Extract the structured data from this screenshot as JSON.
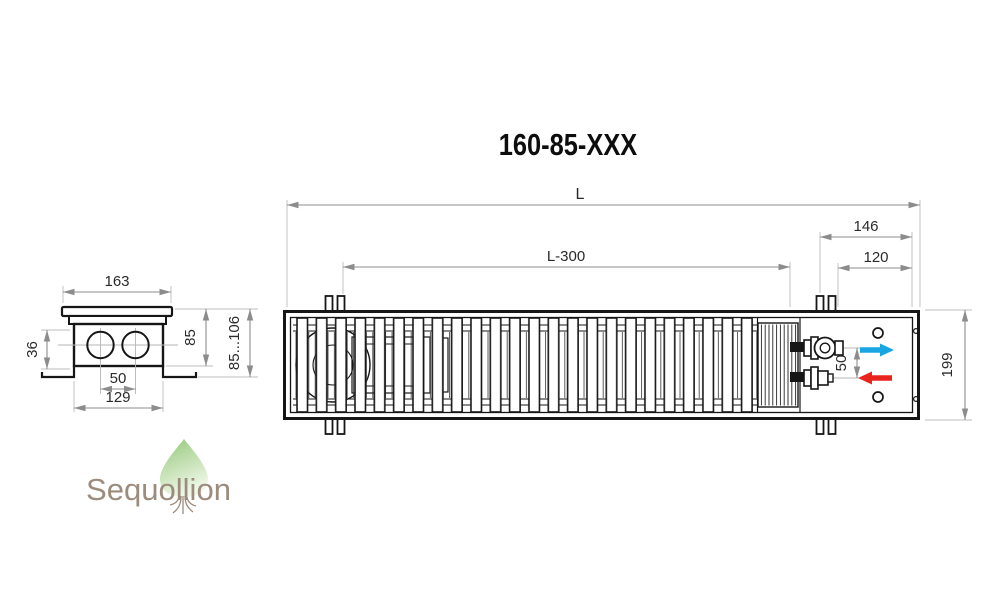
{
  "title": "160-85-XXX",
  "main_view": {
    "dims": {
      "length": "L",
      "grille_length": "L-300",
      "connection_zone": "146",
      "connection_offset": "120",
      "depth": "199",
      "pipe_spacing": "50"
    }
  },
  "section_view": {
    "dims": {
      "top_width": "163",
      "pipe_axis": "36",
      "pipe_spacing": "50",
      "bottom_width": "129",
      "body_height": "85",
      "mount_height": "85...106"
    }
  },
  "flow": {
    "supply_color": "#18a6e3",
    "return_color": "#e8241c"
  },
  "colors": {
    "drawing_line": "#161616",
    "dimension_line": "#8c8c8c",
    "dimension_text": "#2a2a2a",
    "logo_text": "#9c8c7e",
    "logo_tree_dark": "#94c77a",
    "logo_tree_light": "#eff7e7"
  },
  "logo": {
    "name": "Sequollion"
  }
}
